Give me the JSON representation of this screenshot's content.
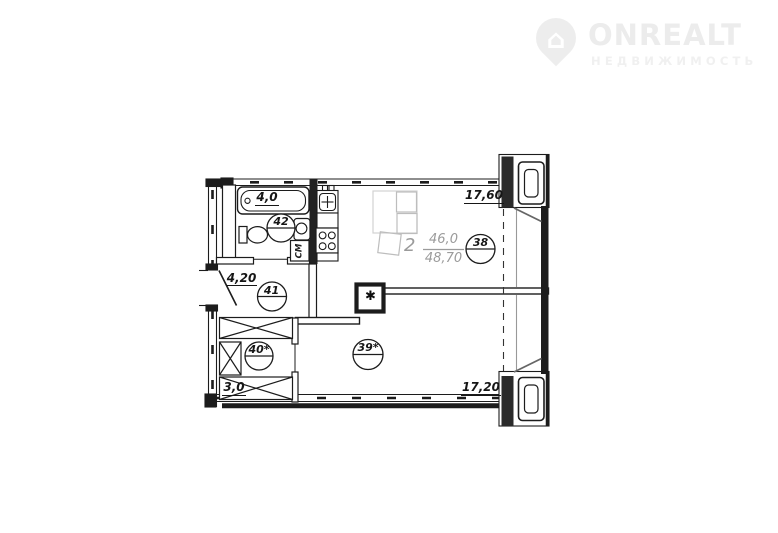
{
  "watermark": {
    "brand": "ONREALT",
    "tagline": "НЕДВИЖИМОСТЬ",
    "icon": "house-pin-icon"
  },
  "apartment": {
    "rooms_count": "2",
    "living_area": "46,0",
    "total_area": "48,70"
  },
  "areas": {
    "bathroom": "4,0",
    "hallway": "4,20",
    "closet": "3,0",
    "kitchen_living": "17,60",
    "bedroom": "17,20"
  },
  "room_numbers": {
    "kitchen_living": "38",
    "bedroom": "39*",
    "closet": "40*",
    "hallway": "41",
    "bathroom": "42"
  },
  "symbols": {
    "washing_machine": "СМ",
    "vent": "✱",
    "house": "⌂"
  },
  "colors": {
    "line": "#1c1c1c",
    "furniture": "#bdbdbd",
    "info_text": "#9b9b9b",
    "watermark": "#ededed"
  }
}
